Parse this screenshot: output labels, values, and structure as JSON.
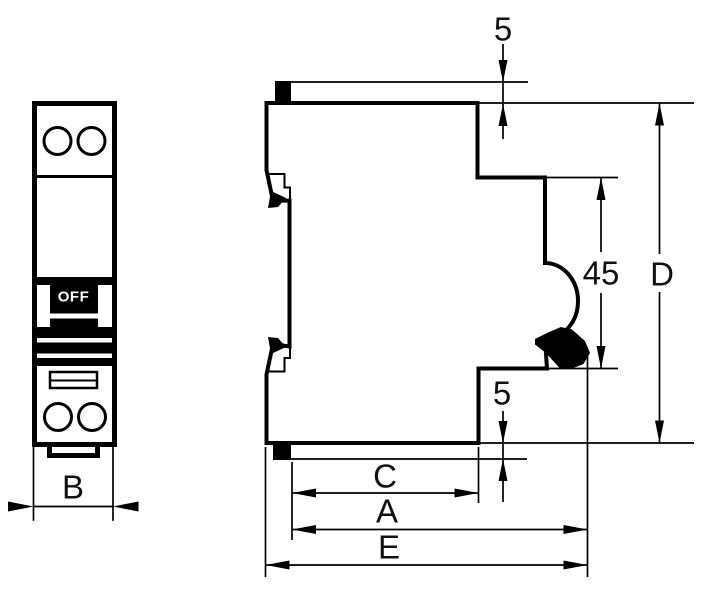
{
  "drawing": {
    "background_color": "#ffffff",
    "line_color": "#000000",
    "front_view": {
      "toggle_label": "OFF",
      "width_dimension_label": "B"
    },
    "side_view": {
      "top_clip_offset_label": "5",
      "bottom_clip_offset_label": "5",
      "rail_recess_height_label": "45",
      "overall_height_label": "D",
      "depth_c_label": "C",
      "depth_a_label": "A",
      "depth_e_label": "E"
    }
  }
}
